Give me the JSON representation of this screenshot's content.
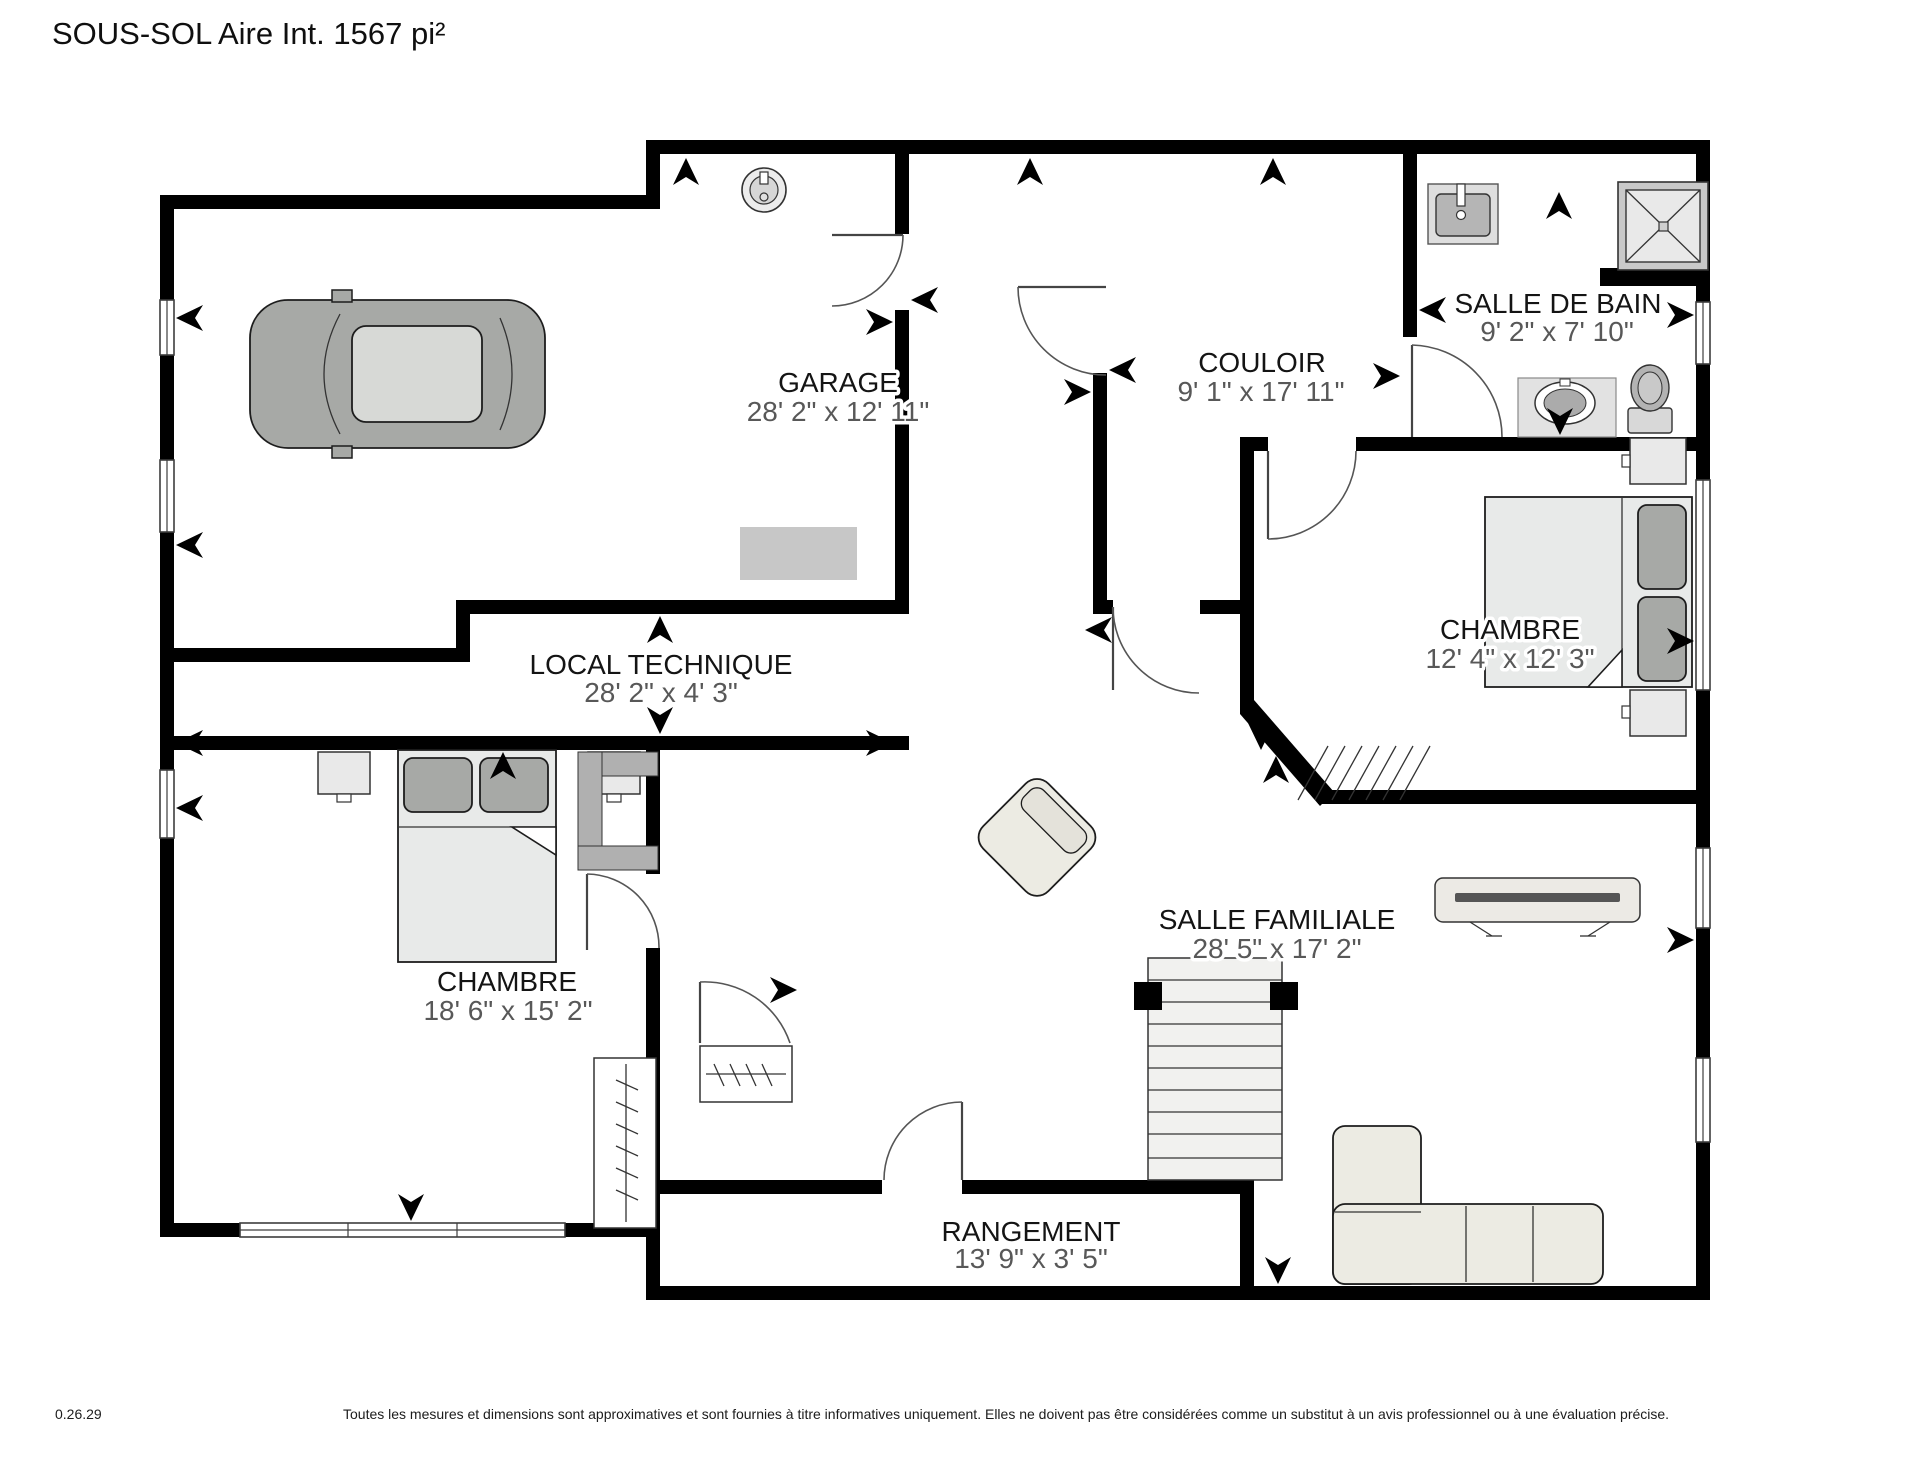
{
  "title": "SOUS-SOL Aire Int. 1567 pi²",
  "rooms": [
    {
      "name": "GARAGE",
      "dims": "28' 2\" x 12' 11\""
    },
    {
      "name": "COULOIR",
      "dims": "9' 1\" x 17' 11\""
    },
    {
      "name": "SALLE DE BAIN",
      "dims": "9' 2\" x 7' 10\""
    },
    {
      "name": "CHAMBRE",
      "dims": "12' 4\" x 12' 3\""
    },
    {
      "name": "LOCAL TECHNIQUE",
      "dims": "28' 2\" x 4' 3\""
    },
    {
      "name": "CHAMBRE",
      "dims": "18' 6\" x 15' 2\""
    },
    {
      "name": "SALLE FAMILIALE",
      "dims": "28' 5\" x 17' 2\""
    },
    {
      "name": "RANGEMENT",
      "dims": "13' 9\" x 3' 5\""
    }
  ],
  "footer": {
    "version": "0.26.29",
    "disclaimer": "Toutes les mesures et dimensions sont approximatives et sont fournies à titre informatives uniquement. Elles ne doivent pas être considérées comme un substitut à un avis professionnel ou à une évaluation précise."
  },
  "colors": {
    "wall": "#000000",
    "room_name_text": "#141414",
    "dimension_text": "#585858",
    "furniture_light": "#ecebe3",
    "furniture_gray": "#a7a9a6",
    "fixture_gray": "#c9c9c9"
  },
  "icons": {
    "direction-arrow": "➤"
  }
}
